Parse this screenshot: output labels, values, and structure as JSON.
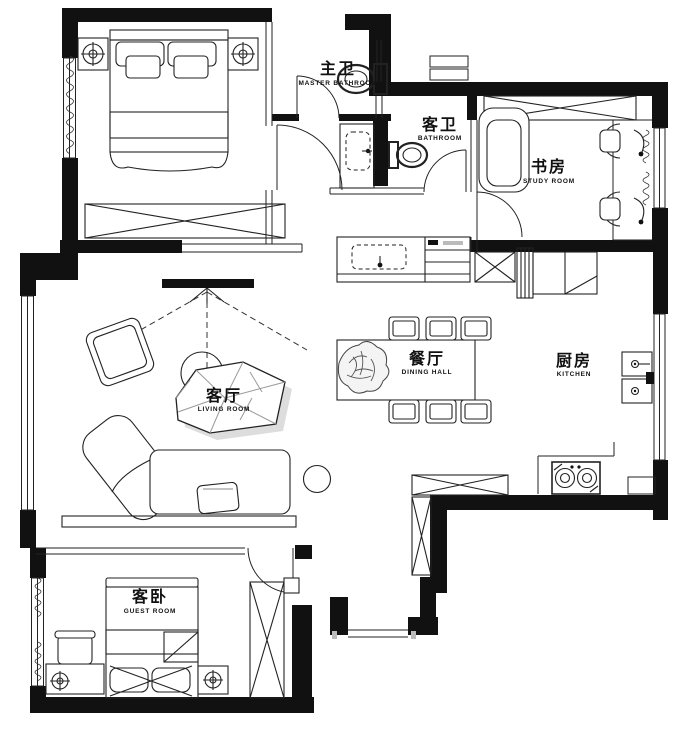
{
  "drawing": {
    "kind": "residential floor plan",
    "colors": {
      "wall": "#111111",
      "line": "#222222",
      "background": "#ffffff"
    }
  },
  "rooms": [
    {
      "id": "master-bathroom",
      "zh": "主卫",
      "en": "MASTER BATHROOM"
    },
    {
      "id": "bathroom",
      "zh": "客卫",
      "en": "BATHROOM"
    },
    {
      "id": "study-room",
      "zh": "书房",
      "en": "STUDY ROOM"
    },
    {
      "id": "dining-hall",
      "zh": "餐厅",
      "en": "DINING HALL"
    },
    {
      "id": "living-room",
      "zh": "客厅",
      "en": "LIVING ROOM"
    },
    {
      "id": "kitchen",
      "zh": "厨房",
      "en": "KITCHEN"
    },
    {
      "id": "guest-room",
      "zh": "客卧",
      "en": "GUEST ROOM"
    }
  ]
}
